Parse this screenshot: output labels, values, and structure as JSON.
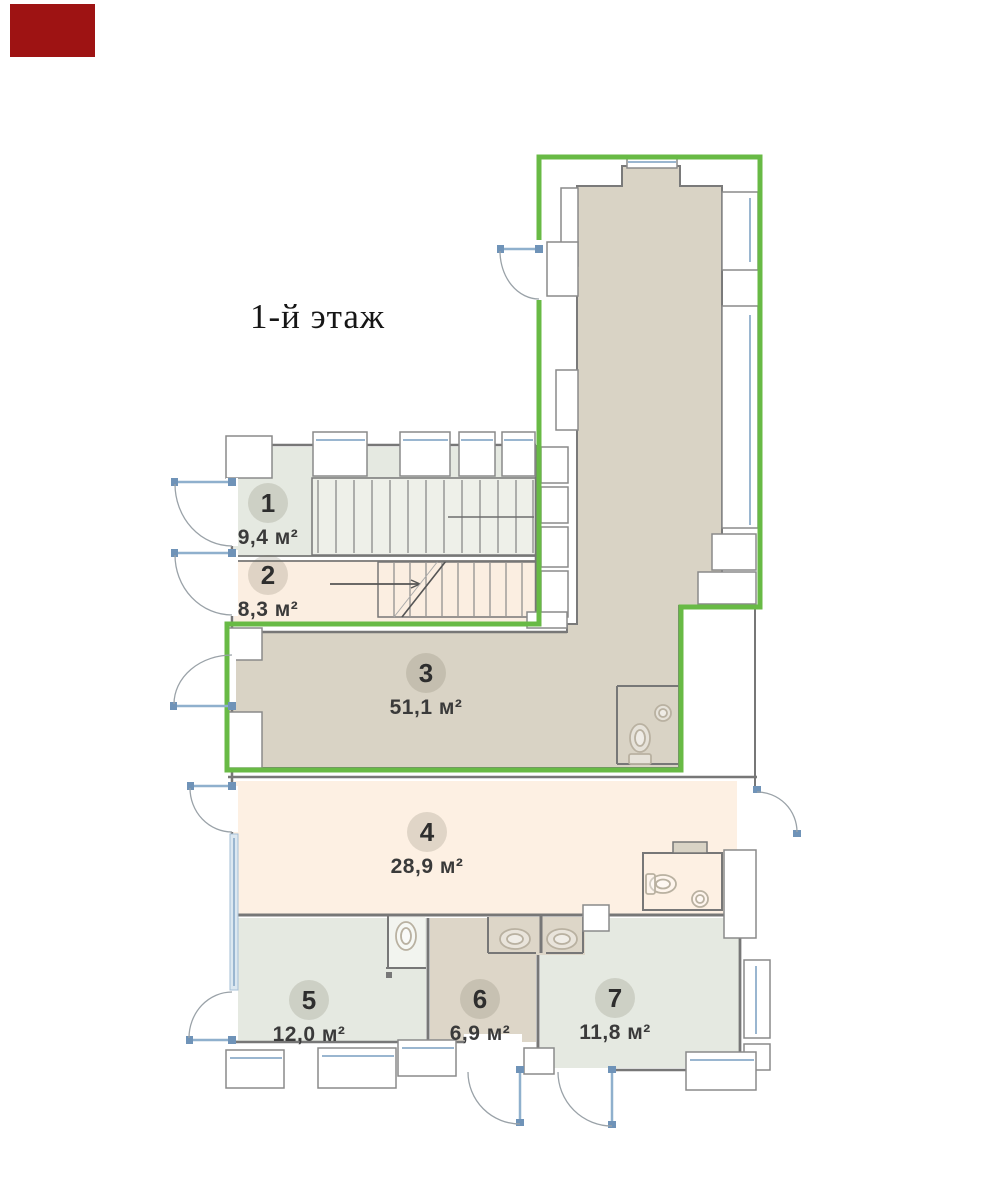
{
  "title": "1-й этаж",
  "rooms": [
    {
      "number": "1",
      "area": "9,4 м²"
    },
    {
      "number": "2",
      "area": "8,3 м²"
    },
    {
      "number": "3",
      "area": "51,1 м²"
    },
    {
      "number": "4",
      "area": "28,9 м²"
    },
    {
      "number": "5",
      "area": "12,0 м²"
    },
    {
      "number": "6",
      "area": "6,9 м²"
    },
    {
      "number": "7",
      "area": "11,8 м²"
    }
  ],
  "colors": {
    "unit_boundary_green": "#68ba45",
    "red_logo_box": "#9e1313",
    "room_sage": "#e5e9e1",
    "room_peach": "#fbeee1",
    "room_peach_light": "#fdf0e3",
    "room_beige": "#d9d3c5",
    "room_tan": "#ddd6c8",
    "wall_gray": "#777777",
    "window_blue": "#8fb0cd"
  }
}
